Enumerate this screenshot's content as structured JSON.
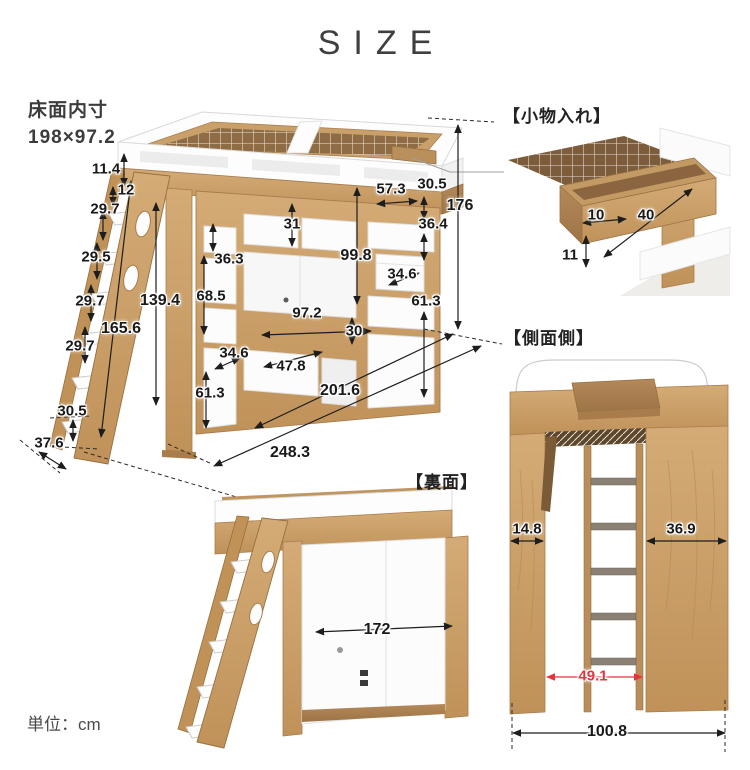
{
  "title": "SIZE",
  "unit_label": "単位：cm",
  "colors": {
    "accent_red": "#e5333b",
    "wood": "#c9a06a"
  },
  "front": {
    "area_label_line1": "床面内寸",
    "area_label_line2": "198×97.2",
    "dims": {
      "ladder_top_gap": "11.4",
      "ladder_hook": "12",
      "step_gap_1": "29.7",
      "step_gap_2": "29.5",
      "step_gap_3": "29.7",
      "step_gap_4": "29.7",
      "ladder_length": "165.6",
      "under_bed_height": "139.4",
      "bottom_step_height": "30.5",
      "ladder_foot_depth": "37.6",
      "left_shelf_top": "36.3",
      "left_shelf_mid": "68.5",
      "left_shelf_lower": "34.6",
      "left_shelf_bottom": "61.3",
      "cubby_height": "31",
      "opening_height": "99.8",
      "opening_width": "97.2",
      "lower_shelf_width": "47.8",
      "lower_height": "30",
      "right_shelf_width": "57.3",
      "right_shelf_top": "30.5",
      "right_drawer_height": "36.4",
      "right_shelf_lower": "34.6",
      "right_shelf_bottom": "61.3",
      "total_height": "176",
      "total_depth": "201.6",
      "total_width": "248.3"
    }
  },
  "komono": {
    "header": "【小物入れ】",
    "dims": {
      "inner_width": "10",
      "length": "40",
      "depth": "11"
    }
  },
  "sokumen": {
    "header": "【側面側】",
    "dims": {
      "left_panel_width": "14.8",
      "right_panel_width": "36.9",
      "opening_width": "49.1",
      "total_width": "100.8"
    }
  },
  "uramen": {
    "header": "【裏面】",
    "dims": {
      "back_width": "172"
    }
  }
}
